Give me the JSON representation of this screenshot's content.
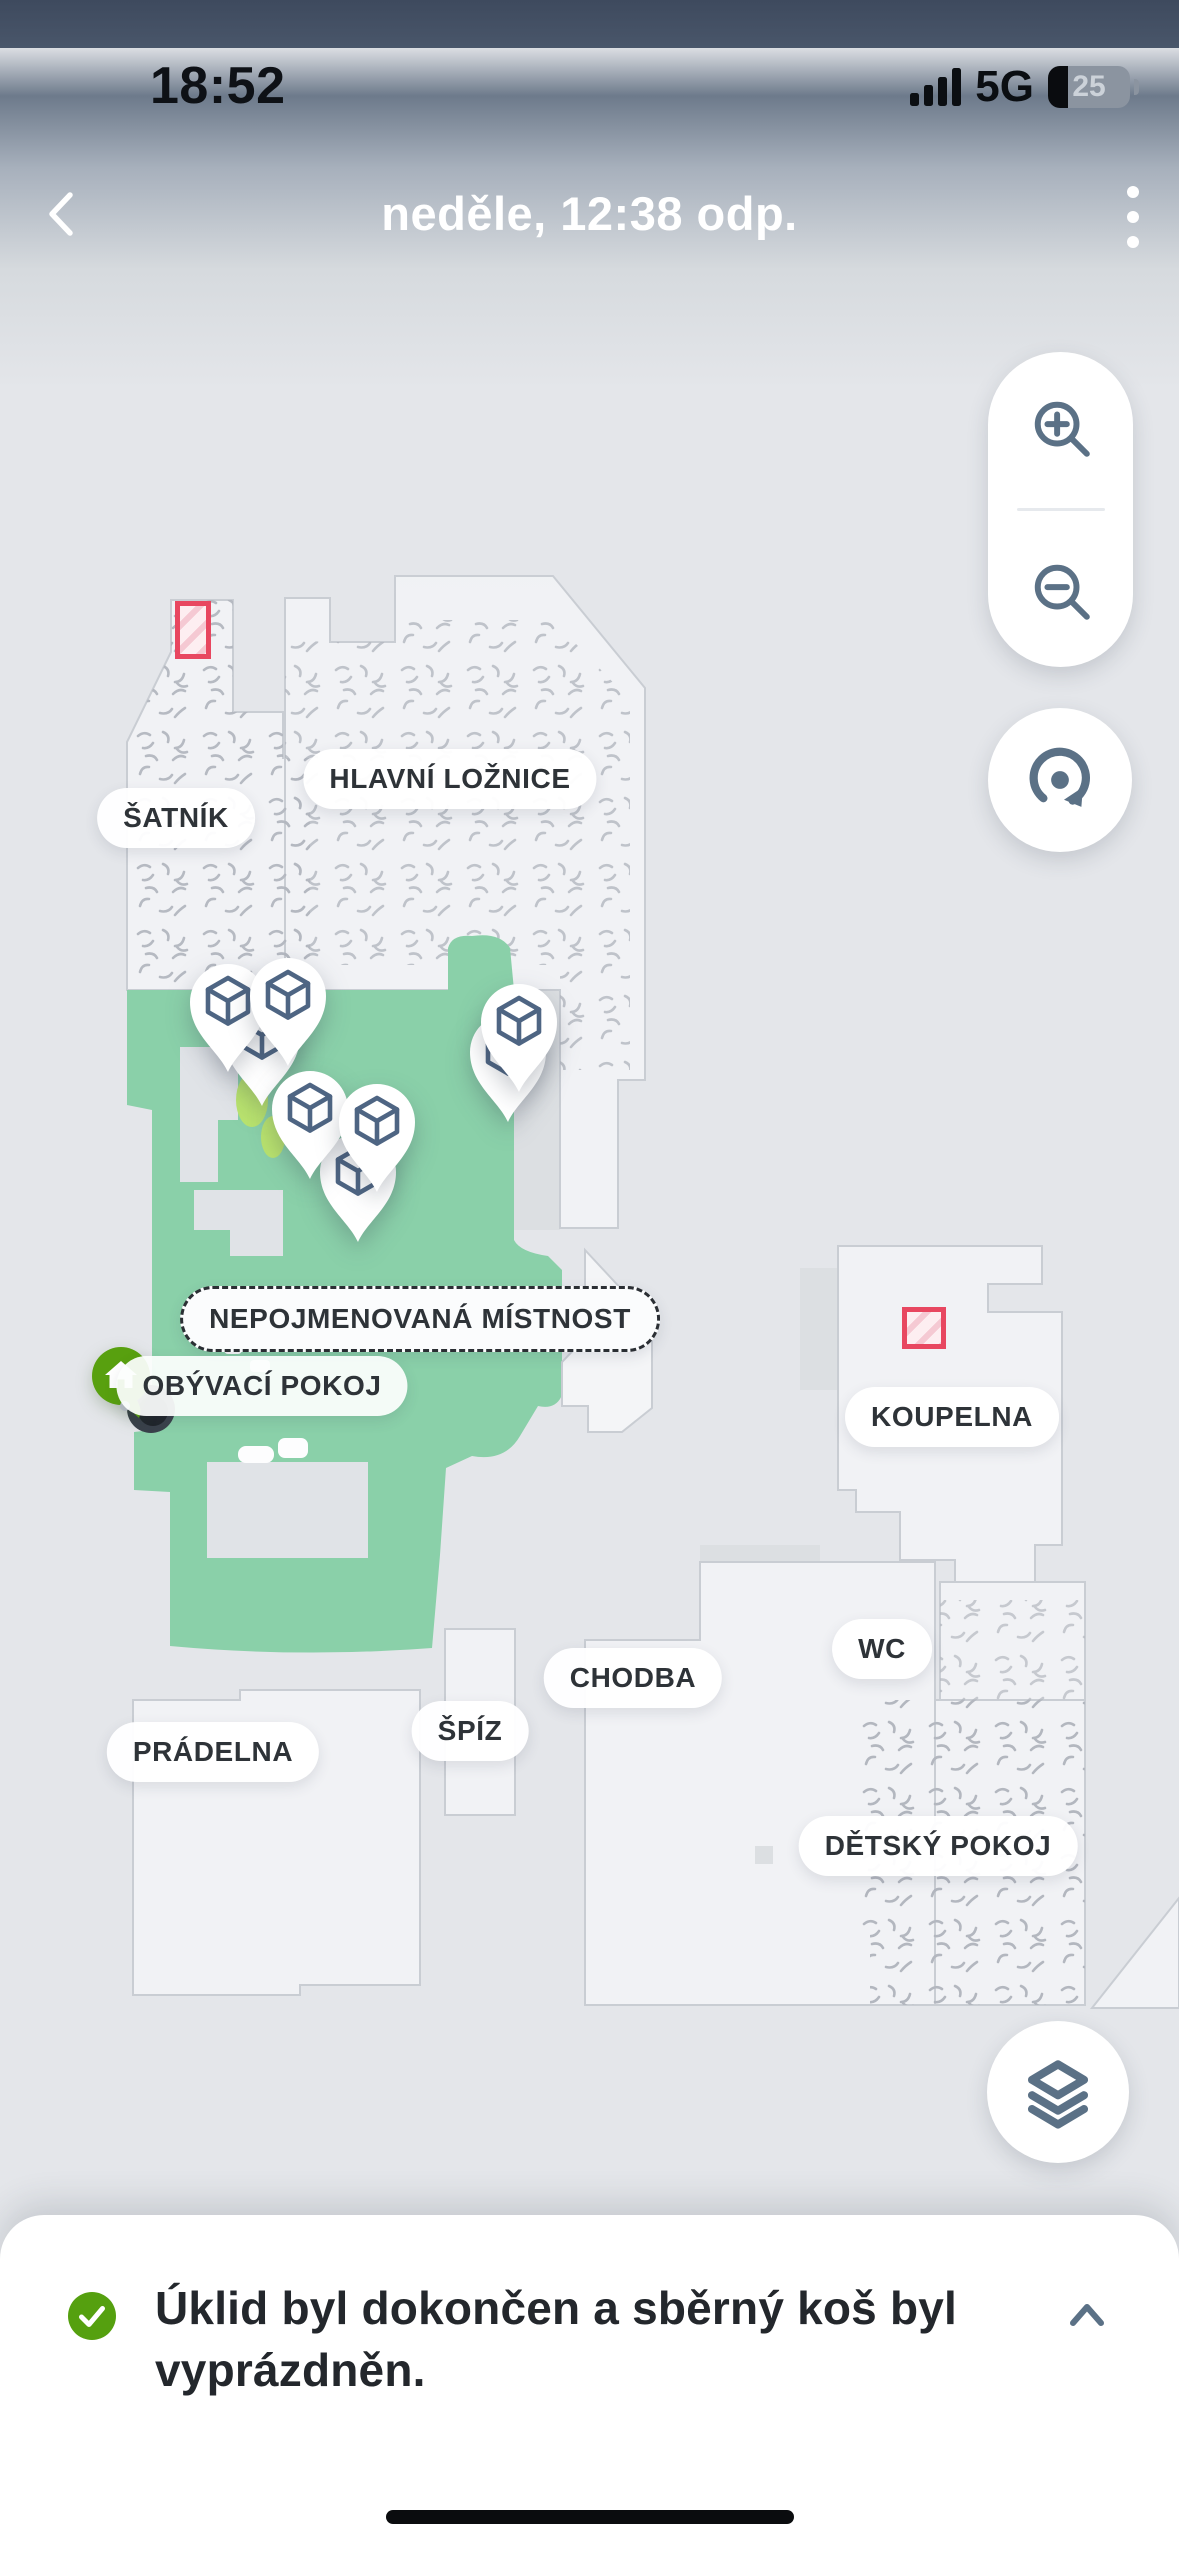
{
  "status_bar": {
    "time": "18:52",
    "signal_icon": "cellular-signal-4-bars",
    "network": "5G",
    "battery_icon": "battery-low",
    "battery_level": "25"
  },
  "nav_bar": {
    "back_icon": "chevron-left",
    "title": "neděle, 12:38 odp.",
    "menu_icon": "kebab-menu"
  },
  "map": {
    "room_labels": [
      {
        "id": "satnik",
        "label": "ŠATNÍK"
      },
      {
        "id": "hlavni-loznice",
        "label": "HLAVNÍ LOŽNICE"
      },
      {
        "id": "nepojmenovana-mistnost",
        "label": "NEPOJMENOVANÁ MÍSTNOST"
      },
      {
        "id": "obyvaci-pokoj",
        "label": "OBÝVACÍ POKOJ"
      },
      {
        "id": "koupelna",
        "label": "KOUPELNA"
      },
      {
        "id": "wc",
        "label": "WC"
      },
      {
        "id": "chodba",
        "label": "CHODBA"
      },
      {
        "id": "spiz",
        "label": "ŠPÍZ"
      },
      {
        "id": "pradelna",
        "label": "PRÁDELNA"
      },
      {
        "id": "detsky-pokoj",
        "label": "DĚTSKÝ POKOJ"
      }
    ],
    "object_pin_count": 8,
    "no_go_zone_count": 2,
    "marker_icons": {
      "object_pin": "detected-object-cube-pin",
      "dock": "home-dock-marker",
      "robot": "robot-vacuum-marker"
    }
  },
  "map_controls": {
    "zoom_in_icon": "zoom-in-magnifier",
    "zoom_out_icon": "zoom-out-magnifier",
    "rotate_icon": "rotate-map",
    "layers_icon": "map-layers"
  },
  "bottom_sheet": {
    "status_icon": "success-check",
    "message": "Úklid byl dokončen a sběrný koš byl vyprázdněn.",
    "collapse_icon": "chevron-up"
  },
  "colors": {
    "cleaned_area": "#8ad0a9",
    "accent_green": "#58a00f",
    "icon_slate": "#5b7186",
    "no_go_red": "#e84760"
  }
}
